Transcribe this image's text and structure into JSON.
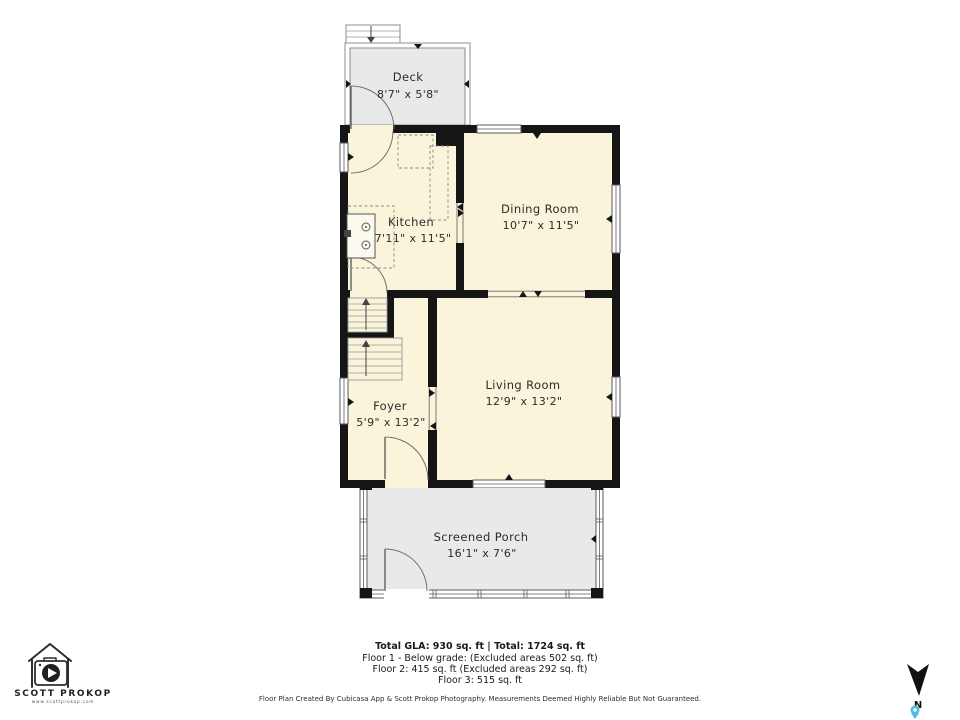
{
  "plan": {
    "rooms": [
      {
        "id": "deck",
        "name": "Deck",
        "dims": "8'7\" x 5'8\""
      },
      {
        "id": "kitchen",
        "name": "Kitchen",
        "dims": "7'11\" x 11'5\""
      },
      {
        "id": "dining",
        "name": "Dining Room",
        "dims": "10'7\" x 11'5\""
      },
      {
        "id": "living",
        "name": "Living Room",
        "dims": "12'9\" x 13'2\""
      },
      {
        "id": "foyer",
        "name": "Foyer",
        "dims": "5'9\" x 13'2\""
      },
      {
        "id": "porch",
        "name": "Screened Porch",
        "dims": "16'1\" x 7'6\""
      }
    ],
    "colors": {
      "room_fill": "#FAF4DA",
      "outdoor_fill": "#E9E9E9",
      "wall": "#151515",
      "pin": "#53B7E8"
    }
  },
  "compass": {
    "label": "N"
  },
  "logo": {
    "brand": "SCOTT PROKOP",
    "website": "www.scottprokop.com"
  },
  "footer": {
    "totals": "Total GLA: 930 sq. ft | Total: 1724 sq. ft",
    "floor_lines": [
      "Floor 1 - Below grade: (Excluded areas 502 sq. ft)",
      "Floor 2: 415 sq. ft (Excluded areas 292 sq. ft)",
      "Floor 3: 515 sq. ft"
    ],
    "disclaimer": "Floor Plan Created By Cubicasa App & Scott Prokop Photography. Measurements Deemed Highly Reliable But Not Guaranteed."
  }
}
